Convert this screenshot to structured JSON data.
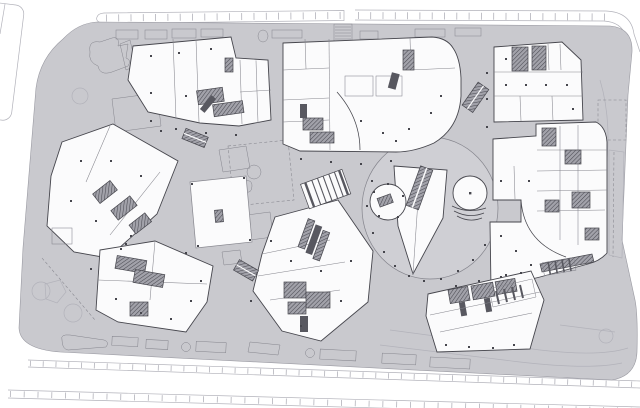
{
  "plan": {
    "kind": "architectural-site-plan",
    "palette": {
      "background": "#ffffff",
      "plaza": "#c9c9ce",
      "plaza_ring": "#cfcfd4",
      "building_fill": "#fbfbfc",
      "annex_fill": "#ececef",
      "line_dark": "#46464d",
      "line_mid": "#85858d",
      "line_light": "#b2b2ba",
      "core_dark": "#585860"
    },
    "legend": {
      "buildings": [
        "building-northwest",
        "building-north-center",
        "building-northeast",
        "building-east-complex",
        "building-west",
        "building-southwest",
        "building-south-center",
        "building-southeast-tower",
        "center-pavilion"
      ],
      "plaza_features": [
        "central-sunken-plaza",
        "round-stage-west",
        "round-stage-east",
        "amphitheater-wedge",
        "plaza-escalators",
        "grand-stair",
        "planters",
        "landscape-beds",
        "canopy-dashed-outline",
        "drop-off-lanes",
        "street-furniture-row"
      ],
      "context": [
        "top-sidewalk-band",
        "crosswalk",
        "south-road-bands",
        "neighbor-block-outline"
      ]
    }
  }
}
